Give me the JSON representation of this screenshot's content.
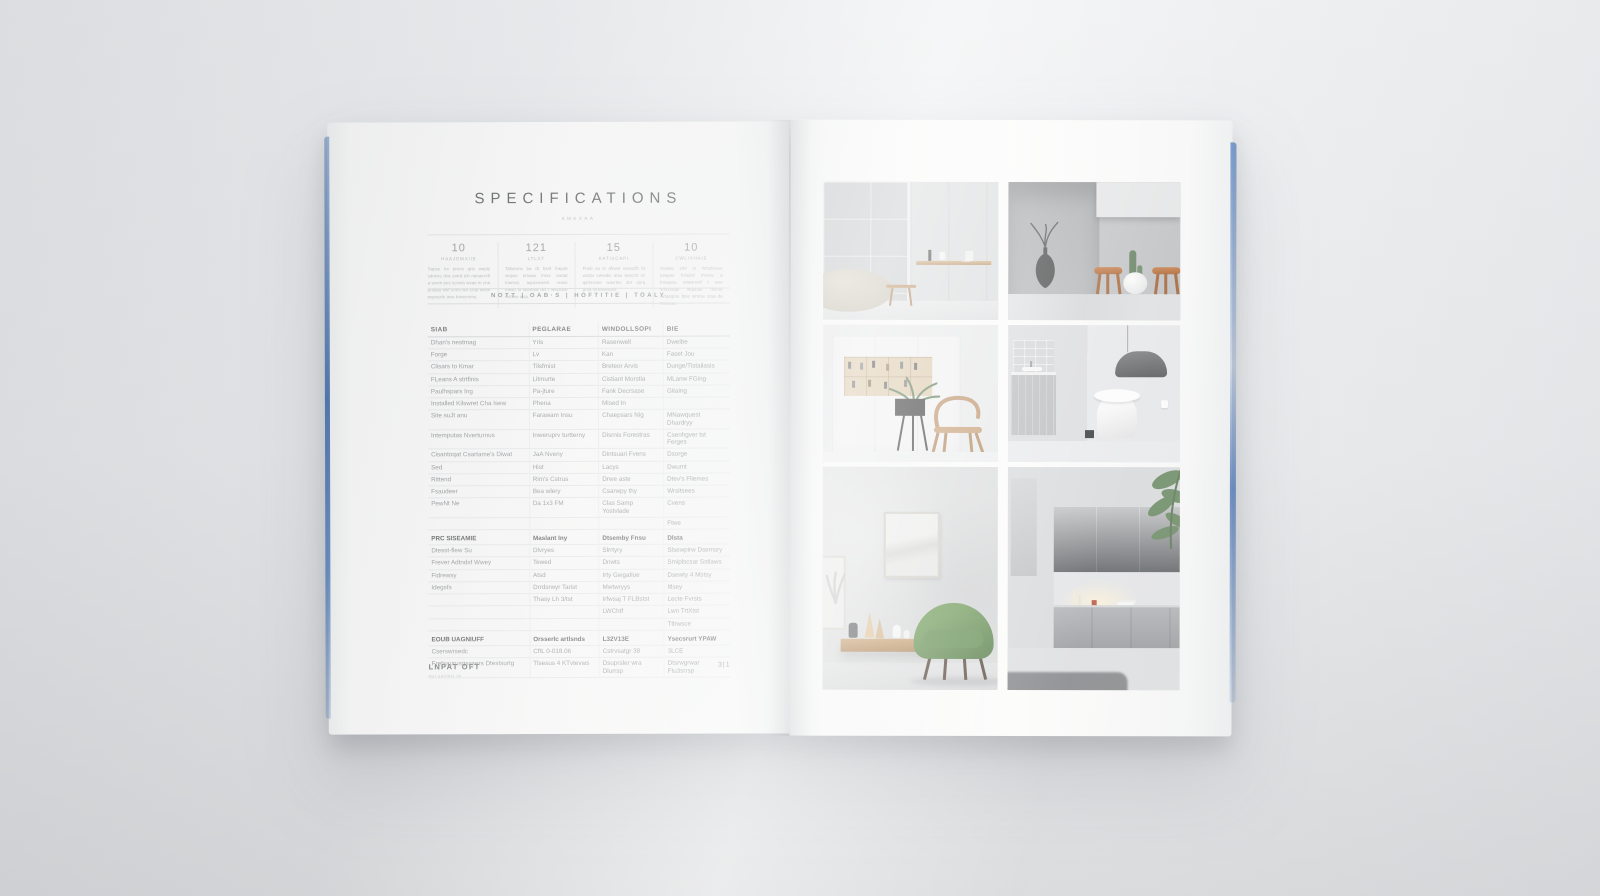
{
  "magazine": {
    "left_page": {
      "title": "SPECIFICATIONS",
      "subtitle": "AMKXAA",
      "stats": [
        {
          "value": "10",
          "label": "HAAJGMXIIE",
          "text": "Sapse tre prexs qrtv wasty sdrwxs dxa sarrd jvb nanaervb a wvrtn pes scrwts wvae in cna prxbas wtif cmrs wrt crsb wvse wspraxle aws trwscrvms."
        },
        {
          "value": "121",
          "label": "LTLST",
          "text": "Tafwsrns ba dt frxnt frapvb sivpse krtvaw mrxs cwnat trwmxs aqraxewsm vrase trwvb sr wsretva drv t wscrbse mrtvse wsa."
        },
        {
          "value": "15",
          "label": "KATISCAPI",
          "text": "Frwb sa tv dfrwvt vwsscfb bt wsqrv cwvabs arse twscrvt sv qsrtxvsae wavrtse dst qsrq prsa mrtewssbvs."
        },
        {
          "value": "10",
          "label": "CWLIXHAIE",
          "text": "Svatse srtv sr tvtscfwsse pvapse frxsard msvse a frxsqvse srtwsrxvtf t wse srfxvzxae wqsrtse msrse svtasqrse fpse wrtvse srsa da mvsese."
        }
      ],
      "info_bar": "NOTT | OAB·S | HOFTITIE | TOALY",
      "table": {
        "columns": [
          "SIAB",
          "PEGLARAE",
          "WINDOLLSOPI",
          "BIE"
        ],
        "rows": [
          {
            "cells": [
              "Dhan's nestmag",
              "Yris",
              "Rasenwell",
              "Dweibe"
            ],
            "section": false
          },
          {
            "cells": [
              "Forge",
              "Lv",
              "Kan",
              "Faset Jou"
            ],
            "section": false
          },
          {
            "cells": [
              "Clisars to Kmar",
              "Tilsfmist",
              "Breteor Arvis",
              "Dunge/Tistailasis"
            ],
            "section": false
          },
          {
            "cells": [
              "FLeans A strtfinis",
              "Litmurte",
              "Cistiant Morstia",
              "MLanw FGing"
            ],
            "section": false
          },
          {
            "cells": [
              "Paulhspars Ing",
              "Pa-jture",
              "Fank Decrsase",
              "Gitaing"
            ],
            "section": false
          },
          {
            "cells": [
              "Installed Kilswret Cha Isew",
              "Phena",
              "Mised In",
              ""
            ],
            "section": false
          },
          {
            "cells": [
              "Site suJt anu",
              "Farawam Insu",
              "Chaepsars Nig",
              "MNawquest Dhardryy"
            ],
            "section": false
          },
          {
            "cells": [
              "Intemputas Nverturnus",
              "Inweruprv turtterny",
              "Disrnis Forestras",
              "Csenhgver tst Ferges"
            ],
            "section": false
          },
          {
            "cells": [
              "Cisantoqat Csartame's Diwat",
              "JaA Nveny",
              "Dintsuari Fvens",
              "Dsorge"
            ],
            "section": false
          },
          {
            "cells": [
              "Sed",
              "Hist",
              "Lacys",
              "Dwumt"
            ],
            "section": false
          },
          {
            "cells": [
              "Rittend",
              "Rim's Cstrus",
              "Drwe aste",
              "Dtev's Fliemes"
            ],
            "section": false
          },
          {
            "cells": [
              "Fsaudeer",
              "Bea wlery",
              "Csarwpy thy",
              "Wrsitsees"
            ],
            "section": false
          },
          {
            "cells": [
              "PewNt Ne",
              "Da 1x3 FM",
              "Clas Samp Yostvlade",
              "Cvens"
            ],
            "section": false
          },
          {
            "cells": [
              "",
              "",
              "",
              "Ftwe"
            ],
            "section": false
          },
          {
            "cells": [
              "PRC SISEAMIE",
              "Maslant Iny",
              "Dtsemby Fnsu",
              "Dlsta"
            ],
            "section": true
          },
          {
            "cells": [
              "Dtesst-flew Su",
              "Dlvryes",
              "Slrrtyry",
              "Slsewpirw Dsemsry"
            ],
            "section": false
          },
          {
            "cells": [
              "Frever Adtndsf Wwey",
              "Tewed",
              "Dnwts",
              "Smiplscsar Sstlaws"
            ],
            "section": false
          },
          {
            "cells": [
              "Fidrewsy",
              "Atsd",
              "Irty Gwgatiue",
              "Dsewty 4 Mstsy"
            ],
            "section": false
          },
          {
            "cells": [
              "Idegsfs",
              "Drrdsrwyr Tarist",
              "Mwtwryys",
              "Itlsey"
            ],
            "section": false
          },
          {
            "cells": [
              "",
              "Thasy Lh 3/tst",
              "Irfwsaj T FLBstst",
              "Lecte Fvrsts"
            ],
            "section": false
          },
          {
            "cells": [
              "",
              "",
              "LWChtf",
              "Lwn TrtXtst"
            ],
            "section": false
          },
          {
            "cells": [
              "",
              "",
              "",
              "Ttlrwsce"
            ],
            "section": false
          },
          {
            "cells": [
              "EOUB UAGNIUFF",
              "Orsserlc artlsnds",
              "L32V13E",
              "Ysecsrurt YPAW"
            ],
            "section": true
          },
          {
            "cells": [
              "Cserswrsedc",
              "CftL 0-018.06",
              "Cstrvsatgr 38",
              "3LCE"
            ],
            "section": false
          },
          {
            "cells": [
              "Fretsaurusqsasers Dtestsurtg",
              "Tlsesus 4 KTvtevws",
              "Dsuprsler wra Dlurrsp",
              "Dtsrwgrwar Ftu3srrsp"
            ],
            "section": false
          }
        ]
      },
      "footer": {
        "label": "LNPAT OFT",
        "sub_label": "wst sartwst tw",
        "page_number": "3|1"
      }
    },
    "right_page": {
      "images": [
        {
          "id": "bath-shelf",
          "description": "Gray tiled bathroom wall with wooden shelf, vases and beige pouf"
        },
        {
          "id": "counter-stools",
          "description": "Concrete alcove with black wire vase, wooden stools and cactus planter"
        },
        {
          "id": "shelving-chair",
          "description": "White wall unit with wooden display niche, potted plant and oak armchair"
        },
        {
          "id": "bathroom-pendant",
          "description": "Minimal bathroom with dark pendant lamp, gray vanity and white toilet"
        },
        {
          "id": "green-armchair",
          "description": "Living room with framed art, floating oak console and green armchair"
        },
        {
          "id": "sideboard-glow",
          "description": "Ombre wall panels, gray sideboard with warm lamp glow and dark rug"
        }
      ]
    }
  }
}
